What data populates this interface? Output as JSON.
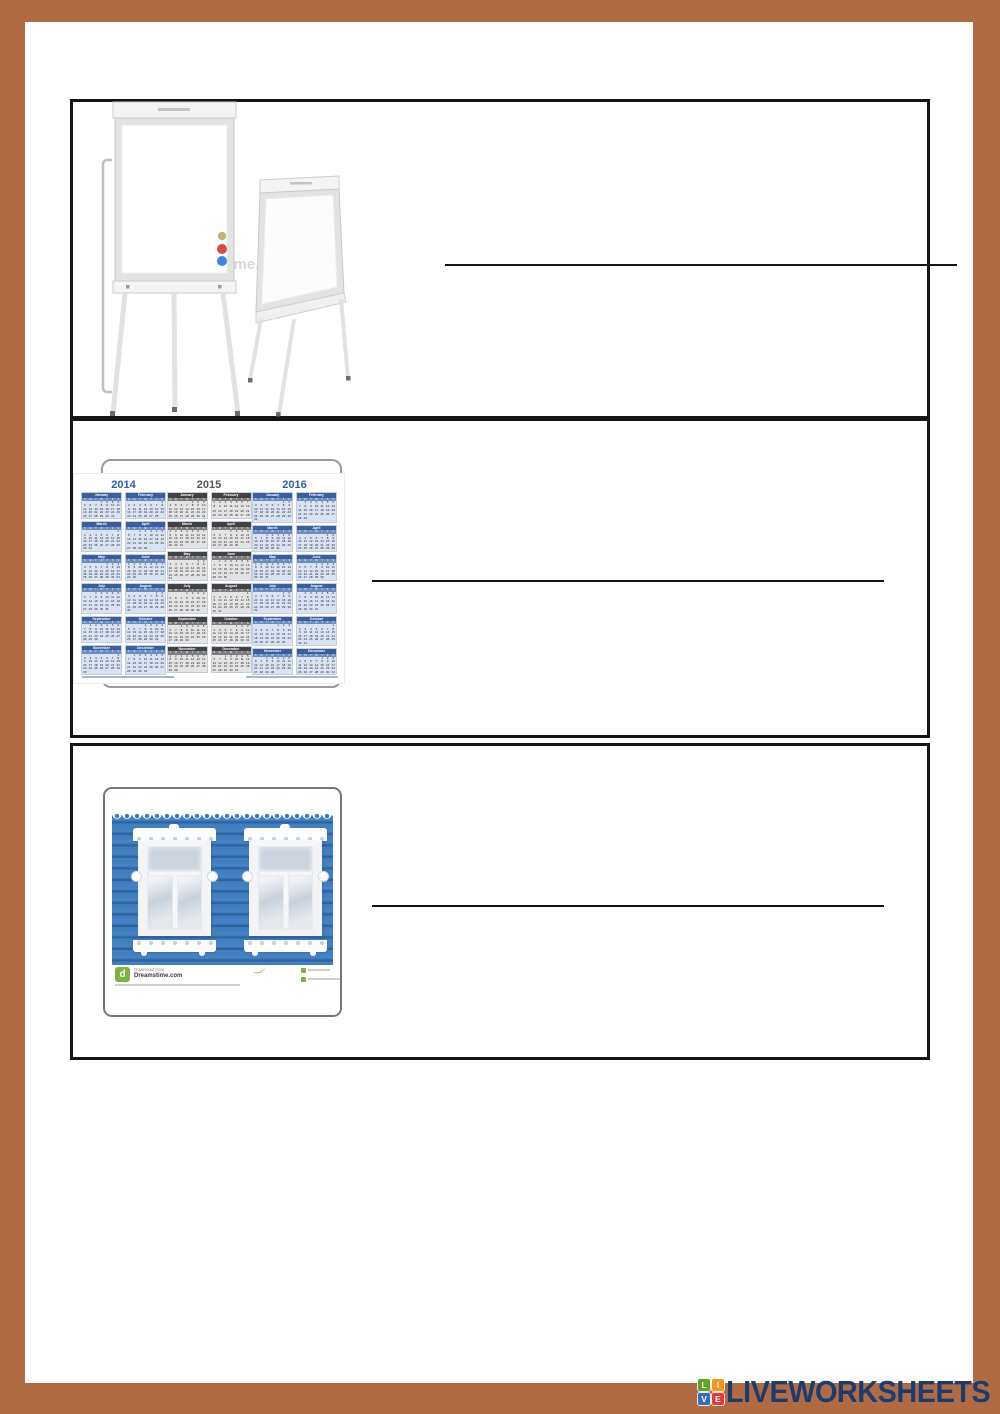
{
  "page": {
    "frame_color": "#b06a44",
    "box_border_color": "#141414"
  },
  "questions": [
    {
      "image": "flipchart-whiteboards",
      "answer": ""
    },
    {
      "image": "three-year-calendar",
      "answer": ""
    },
    {
      "image": "ornate-windows-photo",
      "answer": ""
    }
  ],
  "flipchart": {
    "watermark": "dreamstime.",
    "magnet_colors": [
      "#c9b176",
      "#d84b41",
      "#4186d8"
    ]
  },
  "calendar": {
    "years": [
      {
        "label": "2014",
        "theme": "blue"
      },
      {
        "label": "2015",
        "theme": "gray"
      },
      {
        "label": "2016",
        "theme": "blue"
      }
    ],
    "months": [
      "January",
      "February",
      "March",
      "April",
      "May",
      "June",
      "July",
      "August",
      "September",
      "October",
      "November",
      "December"
    ],
    "day_letters": [
      "S",
      "M",
      "T",
      "W",
      "T",
      "F",
      "S"
    ],
    "themes": {
      "blue": {
        "title": "#2e5ea6",
        "header": "#3a5f9e",
        "days": "#6e8cbd",
        "body": "#d9e3f3"
      },
      "gray": {
        "title": "#555555",
        "header": "#424242",
        "days": "#7d7d7d",
        "body": "#e4e4e4"
      }
    }
  },
  "photo": {
    "download_label": "Download from",
    "site_label": "Dreamstime.com",
    "brand_green": "#7cb342",
    "logo_letter": "d"
  },
  "branding": {
    "tiles": [
      {
        "letter": "L",
        "color": "#5fa32d"
      },
      {
        "letter": "I",
        "color": "#f7941e"
      },
      {
        "letter": "V",
        "color": "#2f6fbd"
      },
      {
        "letter": "E",
        "color": "#e23a36"
      }
    ],
    "wordmark": "LIVEWORKSHEETS",
    "wordmark_color": "#1d3c6e"
  }
}
